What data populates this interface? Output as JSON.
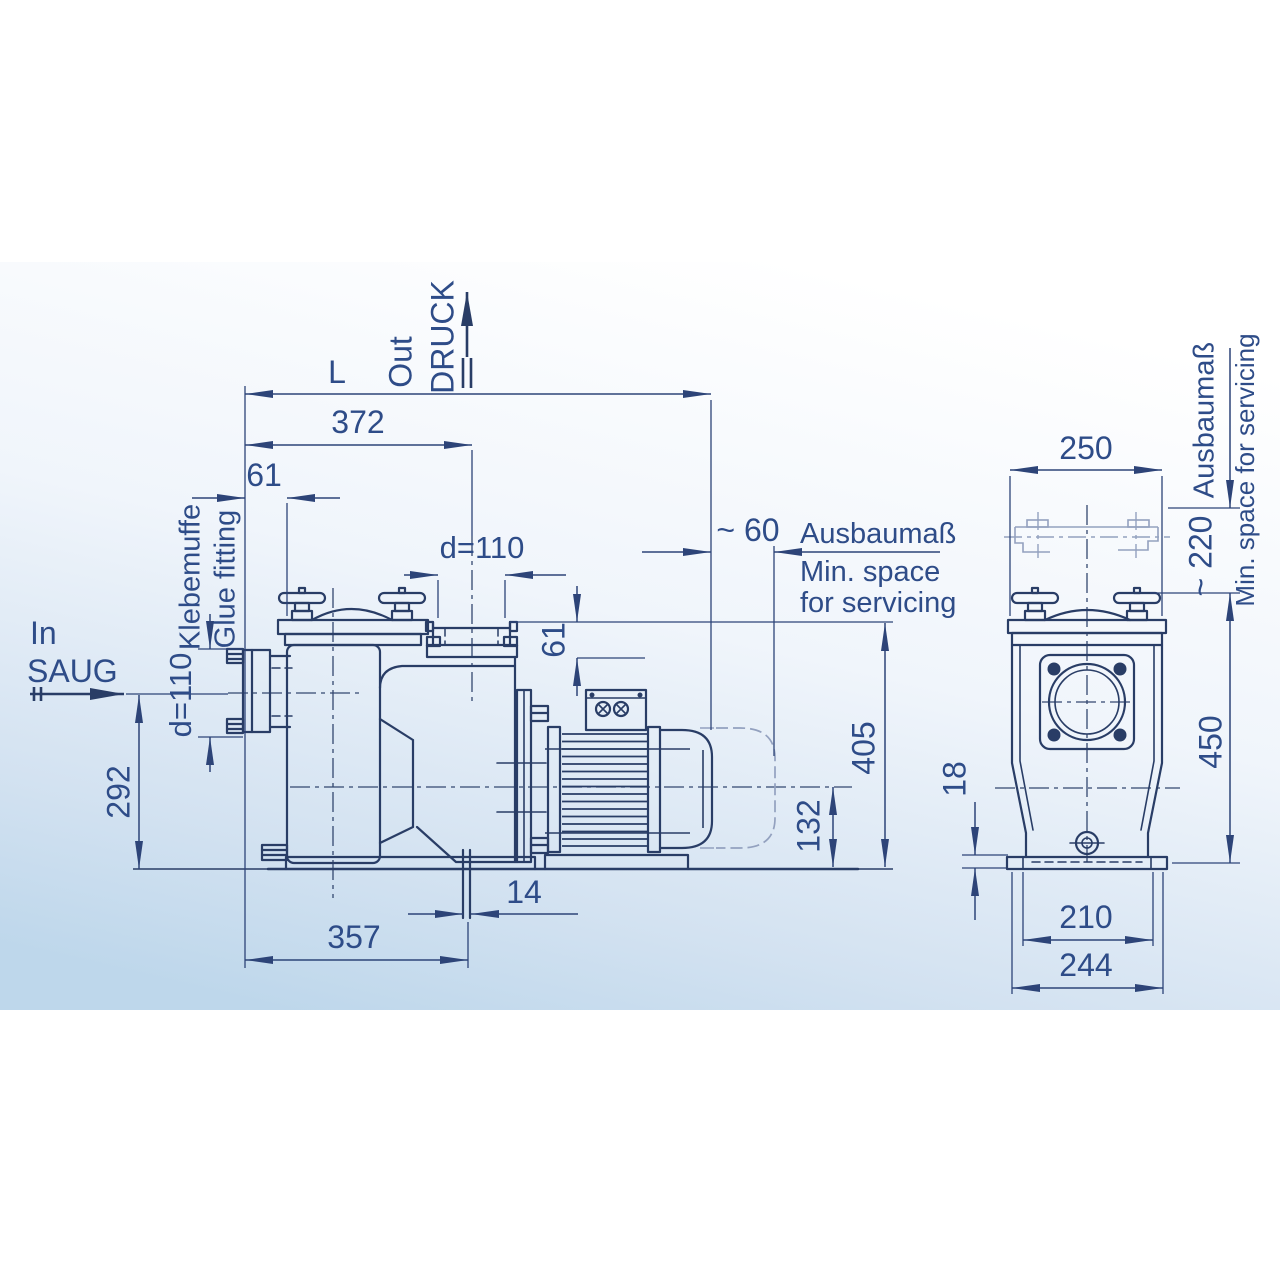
{
  "colors": {
    "line": "#293d66",
    "dimension": "#2d4478",
    "text": "#2e4c88",
    "phantom": "#93a1bf",
    "background_top": "#ffffff",
    "background_bottom": "#bed7eb"
  },
  "side_view": {
    "flow_in": {
      "line1": "In",
      "line2": "SAUG"
    },
    "flow_out": {
      "line1": "Out",
      "line2": "DRUCK"
    },
    "port_label": {
      "de": "Klebemuffe",
      "en": "Glue fitting"
    },
    "service_note": {
      "de": "Ausbaumaß",
      "en_line1": "Min. space",
      "en_line2": "for servicing"
    },
    "dims": {
      "overall_length": "L",
      "length_372": "372",
      "offset_61": "61",
      "discharge_diameter": "d=110",
      "suction_diameter": "d=110",
      "discharge_offset_61": "61",
      "suction_height_292": "292",
      "clearance_60": "~ 60",
      "height_405": "405",
      "shaft_height_132": "132",
      "drain_offset_14": "14",
      "length_357": "357"
    }
  },
  "end_view": {
    "service_note": {
      "de": "Ausbaumaß",
      "en": "Min. space for servicing"
    },
    "dims": {
      "width_250": "250",
      "clearance_220": "~ 220",
      "height_450": "450",
      "base_thickness_18": "18",
      "foot_width_210": "210",
      "base_width_244": "244"
    }
  }
}
